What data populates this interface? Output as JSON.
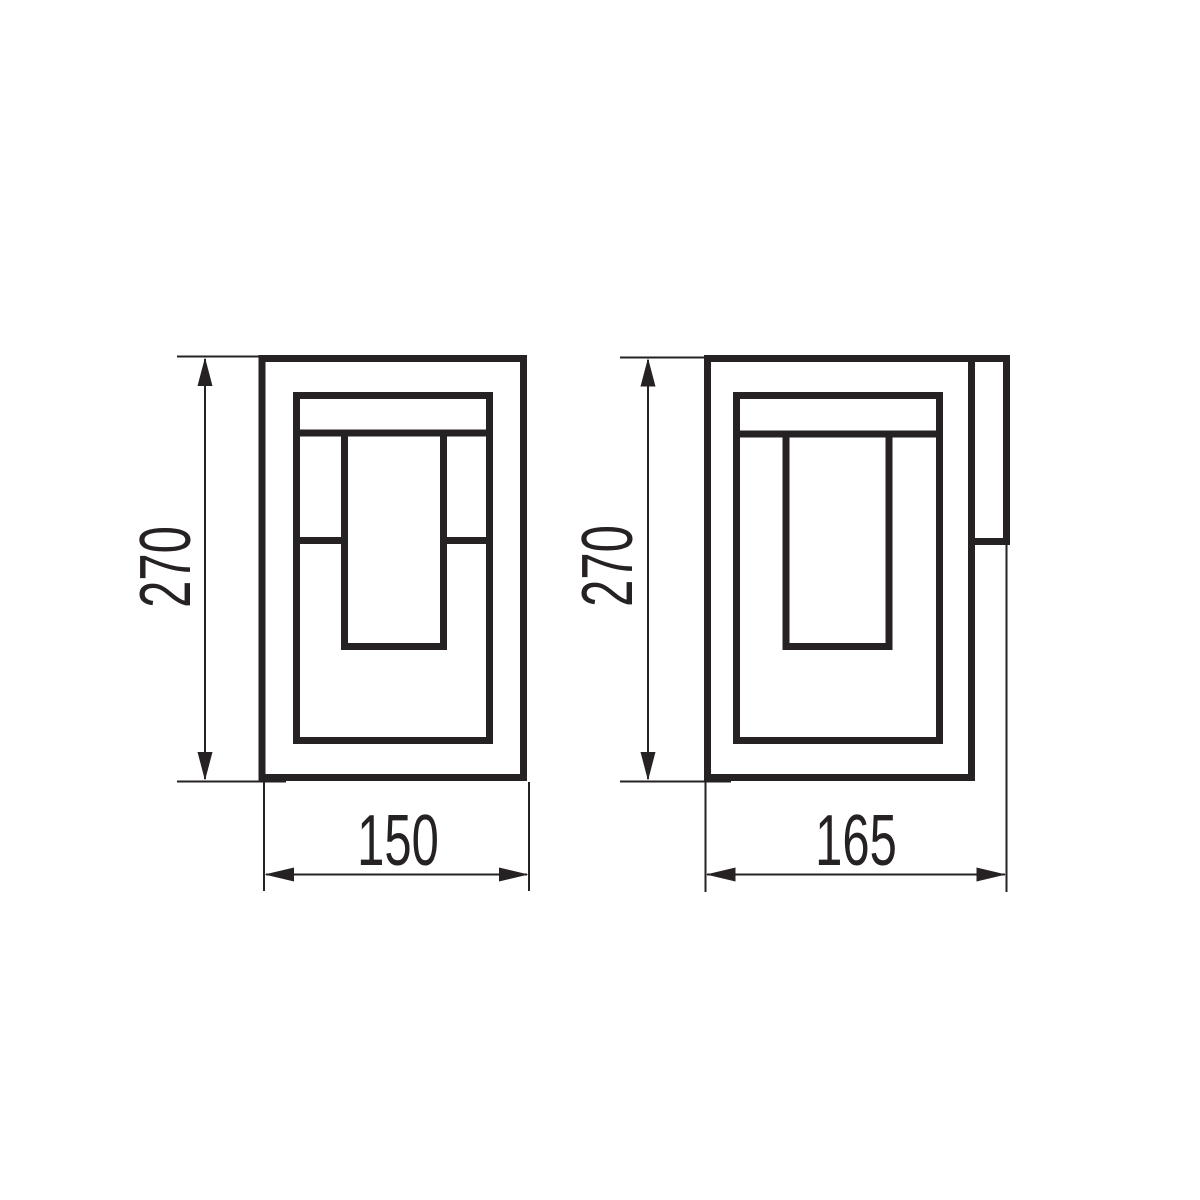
{
  "views": {
    "front": {
      "height_label": "270",
      "width_label": "150"
    },
    "side": {
      "height_label": "270",
      "width_label": "165"
    }
  },
  "colors": {
    "line": "#262223",
    "background": "#ffffff"
  }
}
